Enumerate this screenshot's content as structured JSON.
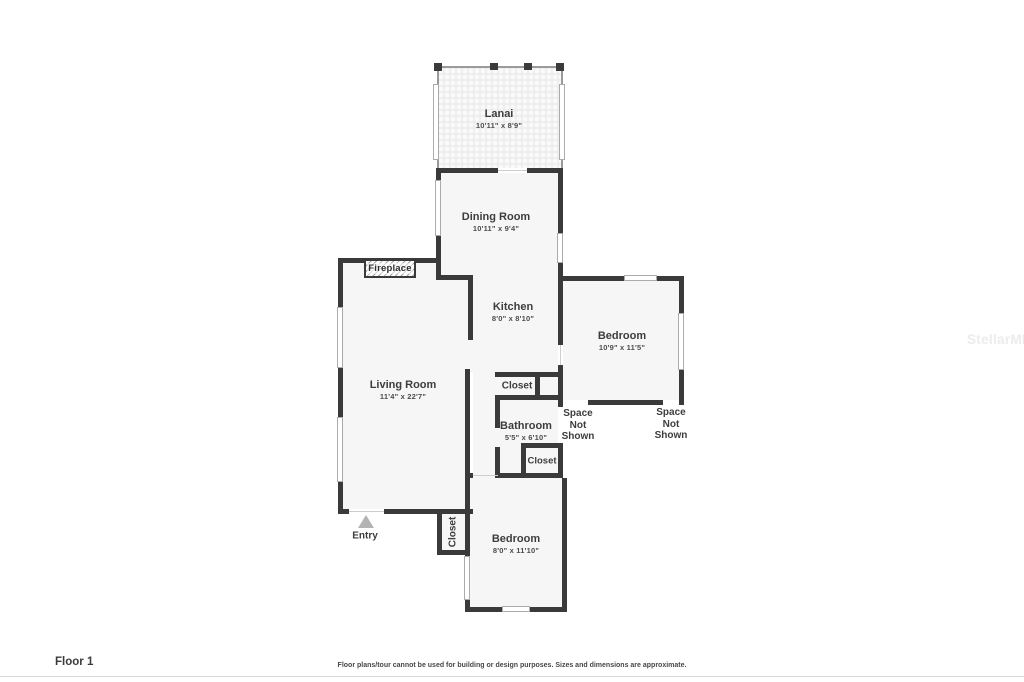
{
  "footer": {
    "floor_label": "Floor 1",
    "disclaimer": "Floor plans/tour cannot be used for building or design purposes. Sizes and dimensions are approximate."
  },
  "watermark": "StellarMLS",
  "colors": {
    "wall": "#3a3a3a",
    "label": "#3d3d3d",
    "room_fill": "#f6f6f6",
    "entry_arrow": "#b3b3b3",
    "watermark": "#ececec"
  },
  "rooms": {
    "lanai": {
      "name": "Lanai",
      "dims": "10'11\" x 8'9\""
    },
    "dining_room": {
      "name": "Dining Room",
      "dims": "10'11\" x 9'4\""
    },
    "kitchen": {
      "name": "Kitchen",
      "dims": "8'0\" x 8'10\""
    },
    "living_room": {
      "name": "Living Room",
      "dims": "11'4\" x 22'7\""
    },
    "bedroom_right": {
      "name": "Bedroom",
      "dims": "10'9\" x 11'5\""
    },
    "bathroom": {
      "name": "Bathroom",
      "dims": "5'5\" x 6'10\""
    },
    "bedroom_bottom": {
      "name": "Bedroom",
      "dims": "8'0\" x 11'10\""
    }
  },
  "features": {
    "fireplace": "Fireplace",
    "closet_top": "Closet",
    "closet_mid": "Closet",
    "closet_entry": "Closet",
    "entry": "Entry",
    "space_not_shown": "Space\nNot\nShown"
  }
}
